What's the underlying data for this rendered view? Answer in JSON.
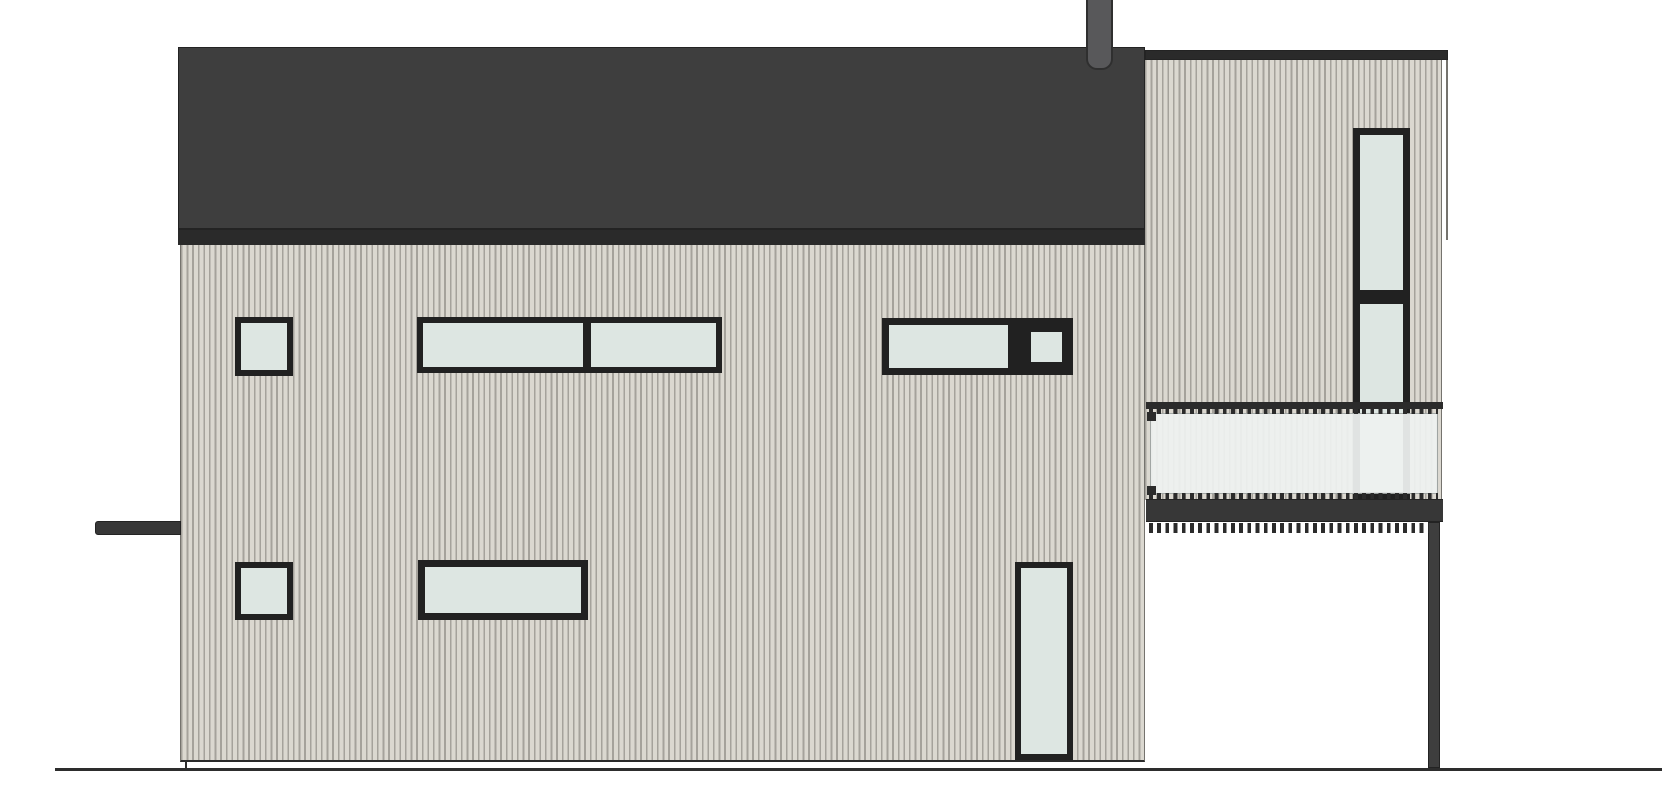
{
  "drawing": {
    "type": "architectural-side-elevation",
    "canvas": {
      "width": 1670,
      "height": 800
    }
  },
  "colors": {
    "background": "#FFFFFF",
    "roof_body": "#3E3E3E",
    "roof_fascia": "#2A2A2A",
    "roof_outline": "#232323",
    "chimney_fill": "#58585A",
    "chimney_outline": "#2F2F2F",
    "siding_light": "#DBD8D0",
    "siding_dark": "#A5A29B",
    "siding_edge": "#75736E",
    "window_frame": "#212121",
    "window_glass": "#DDE6E2",
    "balcony_glass": "#EFF2F1",
    "balcony_dark": "#373737",
    "dash_dark": "#2B2B2B",
    "ground": "#2D2D2D"
  },
  "geometry": {
    "ground_line": [
      55,
      768,
      1607,
      3
    ],
    "roof_body": [
      178,
      47,
      967,
      181
    ],
    "roof_fascia": [
      178,
      228,
      967,
      17
    ],
    "main_wall": [
      180,
      245,
      965,
      517
    ],
    "chimney": [
      1086,
      0,
      27,
      70
    ],
    "awning": [
      95,
      521,
      86,
      14
    ],
    "tower_band": [
      1145,
      50,
      303,
      10
    ],
    "tower_wall": [
      1145,
      60,
      297,
      440
    ],
    "tower_edge_line": [
      1446,
      60,
      2,
      180
    ],
    "balcony_rail": [
      1146,
      402,
      297,
      7
    ],
    "balcony_dash_top": [
      1149,
      409,
      289,
      5
    ],
    "balcony_glass": [
      1150,
      413,
      288,
      81
    ],
    "balcony_nub_top": [
      1147,
      412,
      9,
      9
    ],
    "balcony_nub_bottom": [
      1147,
      486,
      9,
      9
    ],
    "balcony_dash_bottom": [
      1149,
      493,
      289,
      6
    ],
    "balcony_base": [
      1146,
      499,
      297,
      23
    ],
    "balcony_soffit": [
      1149,
      523,
      280,
      10
    ],
    "support_post": [
      1428,
      522,
      12,
      246
    ],
    "grade_step": [
      185,
      760,
      2,
      10
    ]
  },
  "windows": [
    {
      "id": "window-upper-left-small",
      "rect": [
        235,
        317,
        58,
        59
      ],
      "panes": [
        [
          6,
          6,
          46,
          47
        ]
      ]
    },
    {
      "id": "window-upper-middle-band",
      "rect": [
        417,
        317,
        305,
        56
      ],
      "panes": [
        [
          6,
          6,
          160,
          44
        ],
        [
          174,
          6,
          125,
          44
        ]
      ]
    },
    {
      "id": "window-upper-right-band",
      "rect": [
        882,
        318,
        191,
        57
      ],
      "panes": [
        [
          7,
          7,
          119,
          43
        ],
        [
          149,
          14,
          31,
          30
        ]
      ]
    },
    {
      "id": "window-lower-left-small",
      "rect": [
        235,
        562,
        58,
        58
      ],
      "panes": [
        [
          6,
          6,
          46,
          46
        ]
      ]
    },
    {
      "id": "window-lower-middle-wide",
      "rect": [
        418,
        560,
        170,
        60
      ],
      "panes": [
        [
          7,
          7,
          156,
          46
        ]
      ]
    },
    {
      "id": "window-lower-right-tall",
      "rect": [
        1015,
        562,
        58,
        198
      ],
      "panes": [
        [
          6,
          6,
          46,
          186
        ]
      ]
    },
    {
      "id": "window-tower-tall",
      "rect": [
        1353,
        128,
        57,
        372
      ],
      "panes": [
        [
          7,
          7,
          43,
          155
        ],
        [
          7,
          176,
          43,
          188
        ]
      ]
    }
  ]
}
